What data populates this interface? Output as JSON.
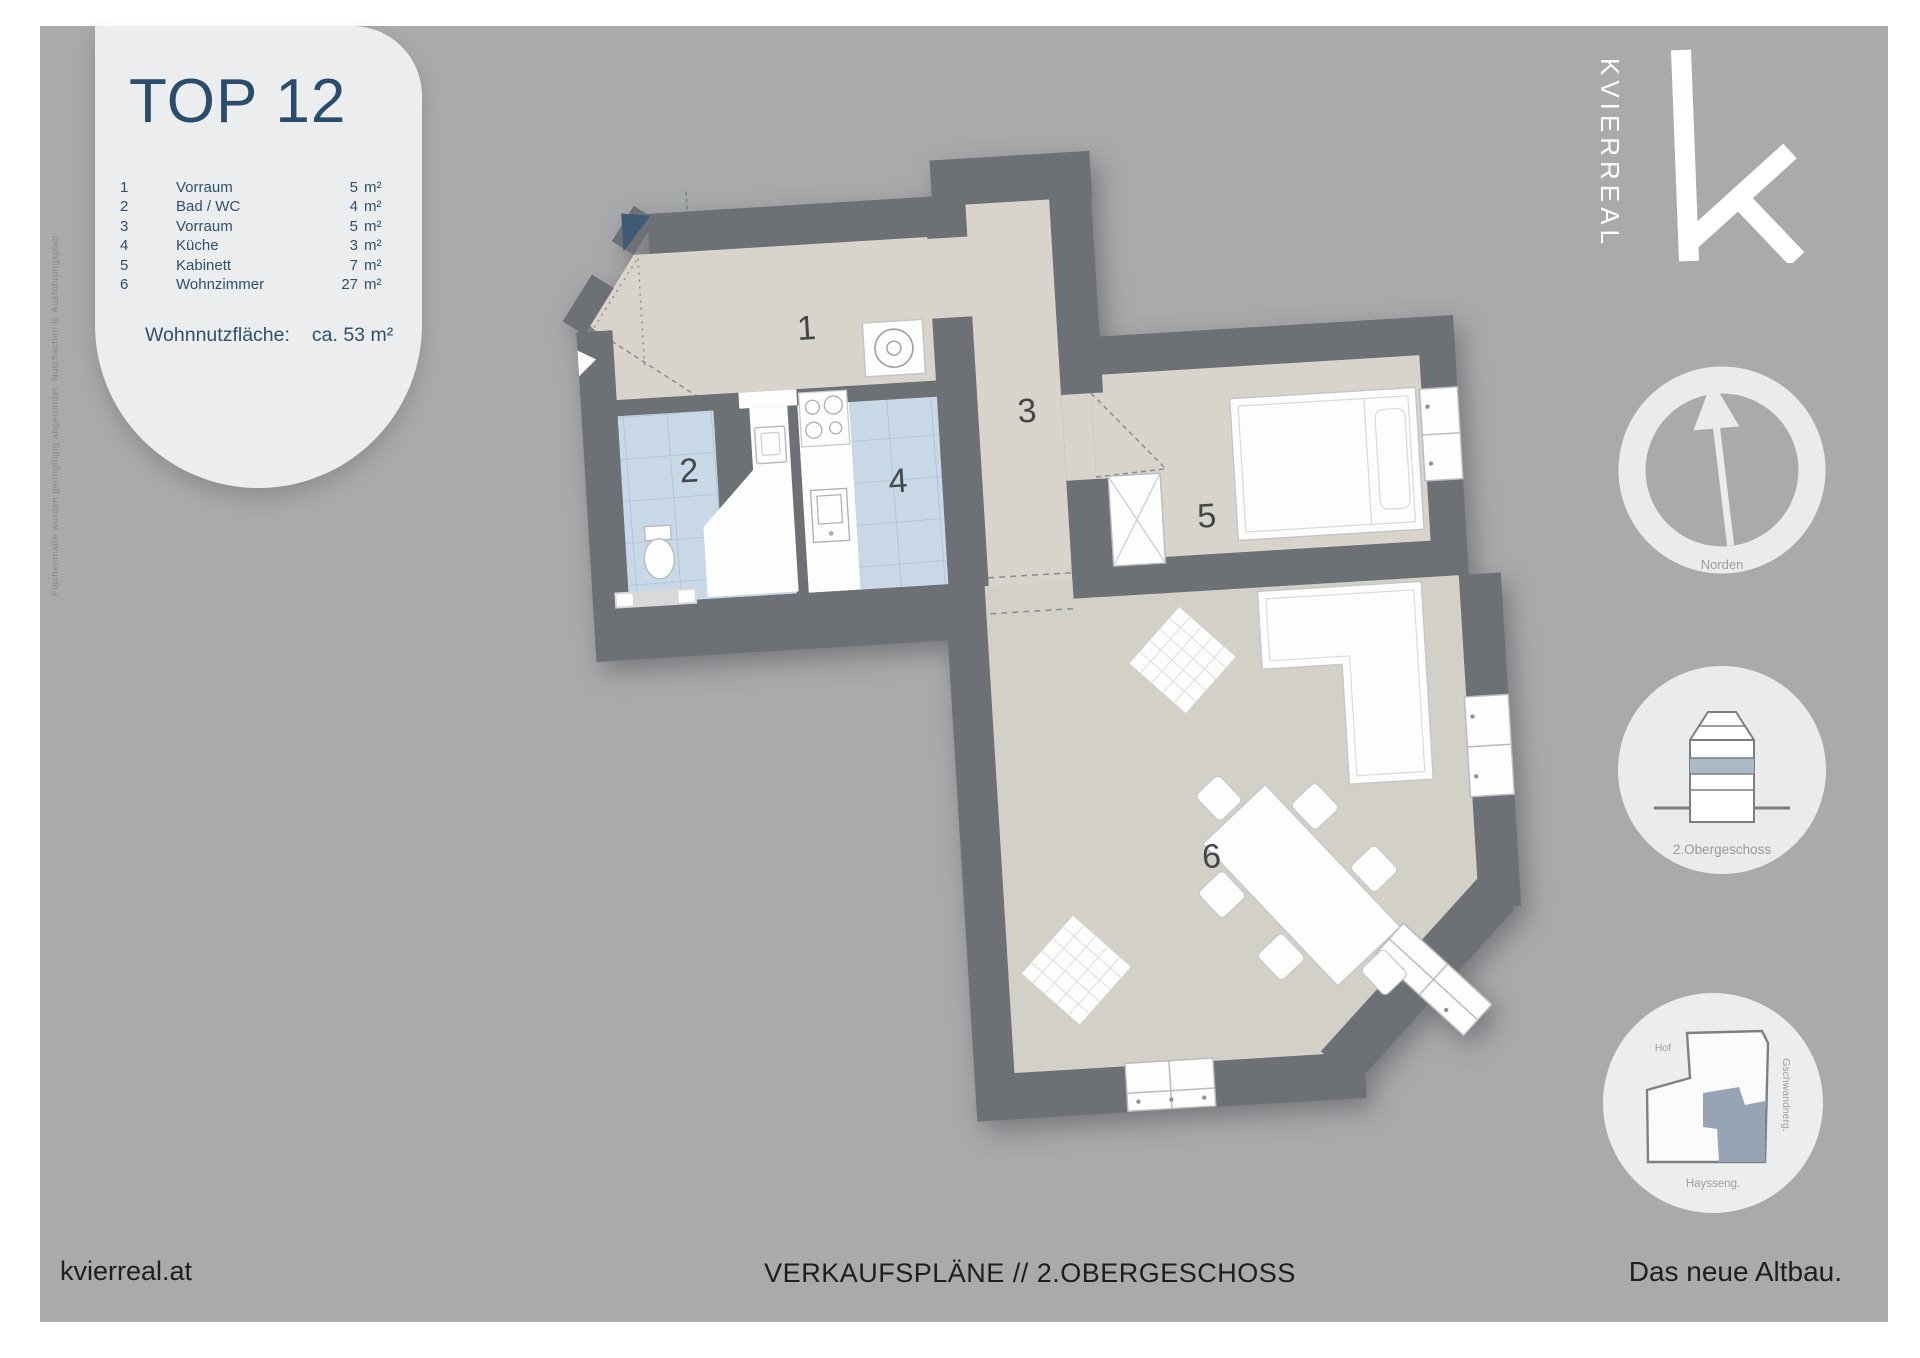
{
  "info_panel": {
    "title": "TOP 12",
    "rooms": [
      {
        "nr": "1",
        "name": "Vorraum",
        "area": "5",
        "unit": "m²"
      },
      {
        "nr": "2",
        "name": "Bad / WC",
        "area": "4",
        "unit": "m²"
      },
      {
        "nr": "3",
        "name": "Vorraum",
        "area": "5",
        "unit": "m²"
      },
      {
        "nr": "4",
        "name": "Küche",
        "area": "3",
        "unit": "m²"
      },
      {
        "nr": "5",
        "name": "Kabinett",
        "area": "7",
        "unit": "m²"
      },
      {
        "nr": "6",
        "name": "Wohnzimmer",
        "area": "27",
        "unit": "m²"
      }
    ],
    "total_label": "Wohnnutzfläche:",
    "total_value": "ca. 53 m²"
  },
  "disclaimer": "Flächenmaße wurden geringfügig abgerundet. Nutzflächen lt. Ausführungsplan",
  "brand": {
    "logo_text": "KVIERREAL"
  },
  "floorplan": {
    "room_numbers": [
      "1",
      "2",
      "3",
      "4",
      "5",
      "6"
    ]
  },
  "compass": {
    "label": "Norden"
  },
  "section_badge": {
    "label": "2.Obergeschoss"
  },
  "siteplan_badge": {
    "label_top": "Hof",
    "label_right": "Gschwandnerg.",
    "label_bottom": "Haysseng."
  },
  "footer": {
    "left": "kvierreal.at",
    "center": "VERKAUFSPLÄNE // 2.OBERGESCHOSS",
    "right": "Das neue Altbau."
  },
  "colors": {
    "background": "#a8aaac",
    "panel": "#ebedee",
    "wall": "#6d7074",
    "floor": "#d8d4cb",
    "floor_living": "#d3d0c8",
    "tile": "#c8d8e6",
    "tile_line": "#a6bccf",
    "title_blue": "#2c4c6c",
    "entrance_navy": "#3e5a77",
    "highlight_storey": "#adb8c5",
    "siteplan_highlight": "#98a4b6",
    "white": "#fdfdfd"
  }
}
